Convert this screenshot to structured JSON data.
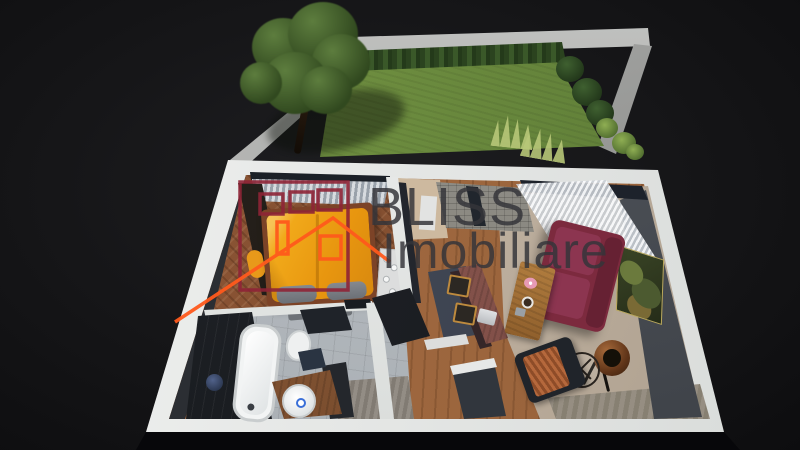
{
  "watermark": {
    "brand_line1": "BLISS",
    "brand_line2": "Imobiliare",
    "text_color": "#343439",
    "logo": {
      "upper_house_icon": "house-outline-with-three-windows-icon",
      "lower_house_icon": "roof-outline-with-chimney-and-window-icon",
      "upper_house_color": "#8e2436",
      "lower_house_color": "#ff5a1c"
    }
  },
  "scene": {
    "type": "3d-top-down-floor-plan-render",
    "background_color": "#131316",
    "garden": {
      "lawn_color": "#6d8f40",
      "hedge_color": "#2b431f",
      "wall_color": "#a8a9a7",
      "elements": [
        "tree",
        "hedge",
        "lawn",
        "perimeter-walls",
        "shrubs",
        "ornamental-grasses"
      ]
    },
    "apartment": {
      "wall_top_color": "#e9ebea",
      "accent_wall_color": "#4a4e55",
      "rooms": [
        {
          "name": "bedroom",
          "floor_color": "#8a5434",
          "bed_color": "#f0a522",
          "furniture": [
            "wardrobe",
            "double-bed",
            "gray-pillows",
            "bench",
            "curtains",
            "pouf"
          ]
        },
        {
          "name": "bathroom",
          "floor_color": "#b4b8bd",
          "furniture": [
            "bathtub",
            "shower",
            "toilet",
            "vessel-sink",
            "wood-vanity",
            "dark-cabinet"
          ]
        },
        {
          "name": "kitchen",
          "island_color": "#3f4552",
          "furniture": [
            "kitchen-island",
            "stone-backsplash",
            "tall-cabinet",
            "glass-shelf"
          ]
        },
        {
          "name": "dining-area",
          "table_color": "#8a5850",
          "furniture": [
            "wood-dining-table",
            "two-wood-chairs",
            "laptop"
          ]
        },
        {
          "name": "living-room",
          "sofa_color": "#7b2a3e",
          "rug_color": "#c6b8a8",
          "furniture": [
            "sofa",
            "coffee-table",
            "floor-lamp",
            "wire-side-table",
            "armchair-with-throw",
            "wall-art",
            "sheer-curtains"
          ]
        },
        {
          "name": "hallway",
          "furniture": [
            "gray-rug",
            "entry-wall-stub"
          ]
        }
      ]
    }
  }
}
